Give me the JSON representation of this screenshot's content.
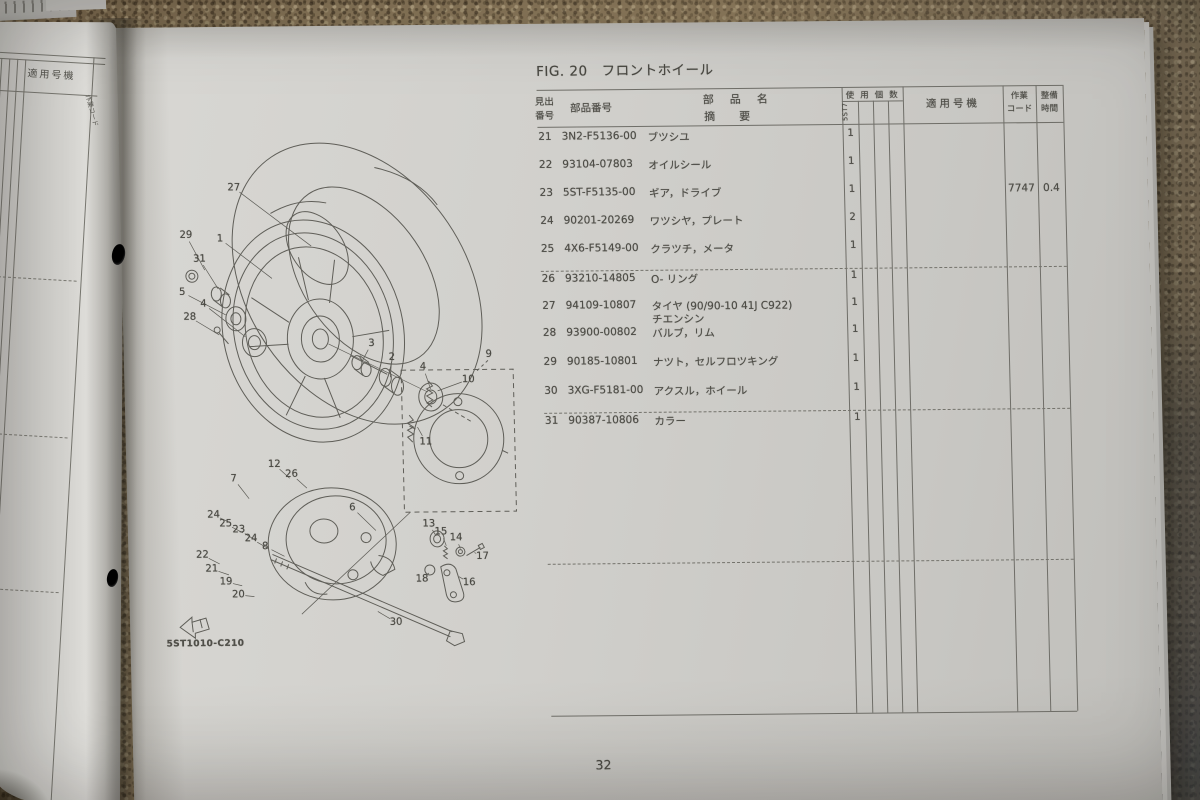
{
  "colors": {
    "paper": "#d0cfcb",
    "paper_left": "#d6d5d1",
    "ink": "#4e4d47",
    "carpet": "#8d7b5d",
    "carpet_dark": "#5c5a55"
  },
  "left_page": {
    "applicable_model_header": "適用号機",
    "edge_fragment": "作業コード"
  },
  "catalog_page": {
    "title": "FIG. 20　フロントホイール",
    "page_number": "32",
    "diagram_code": "5ST1010-C210",
    "table": {
      "headers": {
        "ref_line1": "見出",
        "ref_line2": "番号",
        "part_no": "部品番号",
        "name_line1": "部品名",
        "name_line2": "摘要",
        "qty": "使用個数",
        "model_code": "5ST7",
        "applicable": "適用号機",
        "work1": "作業",
        "work2": "コード",
        "time1": "整備",
        "time2": "時間"
      },
      "rows": [
        {
          "ref": "21",
          "part": "3N2-F5136-00",
          "name": "ブツシユ",
          "qty": "1",
          "work_code": "",
          "time": ""
        },
        {
          "ref": "22",
          "part": "93104-07803",
          "name": "オイルシール",
          "qty": "1",
          "work_code": "",
          "time": ""
        },
        {
          "ref": "23",
          "part": "5ST-F5135-00",
          "name": "ギア，ドライブ",
          "qty": "1",
          "work_code": "7747",
          "time": "0.4"
        },
        {
          "ref": "24",
          "part": "90201-20269",
          "name": "ワツシヤ，プレート",
          "qty": "2",
          "work_code": "",
          "time": ""
        },
        {
          "ref": "25",
          "part": "4X6-F5149-00",
          "name": "クラツチ，メータ",
          "qty": "1",
          "work_code": "",
          "time": ""
        },
        {
          "ref": "26",
          "part": "93210-14805",
          "name": "O- リング",
          "qty": "1",
          "work_code": "",
          "time": ""
        },
        {
          "ref": "27",
          "part": "94109-10807",
          "name": "タイヤ (90/90-10 41J C922)",
          "name2": "チエンシン",
          "qty": "1",
          "work_code": "",
          "time": ""
        },
        {
          "ref": "28",
          "part": "93900-00802",
          "name": "バルブ，リム",
          "qty": "1",
          "work_code": "",
          "time": ""
        },
        {
          "ref": "29",
          "part": "90185-10801",
          "name": "ナツト，セルフロツキング",
          "qty": "1",
          "work_code": "",
          "time": ""
        },
        {
          "ref": "30",
          "part": "3XG-F5181-00",
          "name": "アクスル，ホイール",
          "qty": "1",
          "work_code": "",
          "time": ""
        },
        {
          "ref": "31",
          "part": "90387-10806",
          "name": "カラー",
          "qty": "1",
          "work_code": "",
          "time": ""
        }
      ]
    },
    "diagram": {
      "callouts": [
        {
          "n": "27",
          "x": 114,
          "y": 161,
          "tx": 190,
          "ty": 220
        },
        {
          "n": "1",
          "x": 99,
          "y": 212,
          "tx": 150,
          "ty": 252
        },
        {
          "n": "29",
          "x": 65,
          "y": 208,
          "tx": 83,
          "ty": 243
        },
        {
          "n": "31",
          "x": 78,
          "y": 232,
          "tx": 96,
          "ty": 262
        },
        {
          "n": "5",
          "x": 60,
          "y": 265,
          "tx": 103,
          "ty": 288
        },
        {
          "n": "4",
          "x": 81,
          "y": 277,
          "tx": 122,
          "ty": 310
        },
        {
          "n": "28",
          "x": 67,
          "y": 290,
          "tx": 96,
          "ty": 308
        },
        {
          "n": "3",
          "x": 248,
          "y": 318,
          "tx": 238,
          "ty": 336
        },
        {
          "n": "2",
          "x": 268,
          "y": 332,
          "tx": 266,
          "ty": 352
        },
        {
          "n": "4",
          "x": 299,
          "y": 342,
          "tx": 306,
          "ty": 364
        },
        {
          "n": "9",
          "x": 365,
          "y": 330
        },
        {
          "n": "10",
          "x": 344,
          "y": 355,
          "tx": 313,
          "ty": 366
        },
        {
          "n": "11",
          "x": 300,
          "y": 417,
          "tx": 292,
          "ty": 402
        },
        {
          "n": "12",
          "x": 148,
          "y": 438,
          "tx": 163,
          "ty": 452
        },
        {
          "n": "26",
          "x": 165,
          "y": 448,
          "tx": 180,
          "ty": 462
        },
        {
          "n": "7",
          "x": 107,
          "y": 452,
          "tx": 122,
          "ty": 472
        },
        {
          "n": "24",
          "x": 86,
          "y": 488,
          "tx": 103,
          "ty": 496
        },
        {
          "n": "25",
          "x": 98,
          "y": 497,
          "tx": 115,
          "ty": 506
        },
        {
          "n": "23",
          "x": 111,
          "y": 503,
          "tx": 128,
          "ty": 514
        },
        {
          "n": "24",
          "x": 123,
          "y": 512,
          "tx": 140,
          "ty": 522
        },
        {
          "n": "8",
          "x": 137,
          "y": 520,
          "tx": 156,
          "ty": 530
        },
        {
          "n": "6",
          "x": 225,
          "y": 482,
          "tx": 248,
          "ty": 505
        },
        {
          "n": "22",
          "x": 74,
          "y": 528,
          "tx": 91,
          "ty": 537
        },
        {
          "n": "21",
          "x": 83,
          "y": 542,
          "tx": 100,
          "ty": 548
        },
        {
          "n": "19",
          "x": 97,
          "y": 555,
          "tx": 113,
          "ty": 559
        },
        {
          "n": "20",
          "x": 109,
          "y": 568,
          "tx": 125,
          "ty": 570
        },
        {
          "n": "13",
          "x": 301,
          "y": 499,
          "tx": 308,
          "ty": 511
        },
        {
          "n": "15",
          "x": 313,
          "y": 507,
          "tx": 318,
          "ty": 521
        },
        {
          "n": "14",
          "x": 328,
          "y": 513,
          "tx": 332,
          "ty": 524
        },
        {
          "n": "17",
          "x": 354,
          "y": 532,
          "tx": 346,
          "ty": 528
        },
        {
          "n": "18",
          "x": 293,
          "y": 554,
          "tx": 300,
          "ty": 548
        },
        {
          "n": "16",
          "x": 340,
          "y": 558,
          "tx": 330,
          "ty": 552
        },
        {
          "n": "30",
          "x": 266,
          "y": 597,
          "tx": 248,
          "ty": 586
        }
      ]
    }
  }
}
